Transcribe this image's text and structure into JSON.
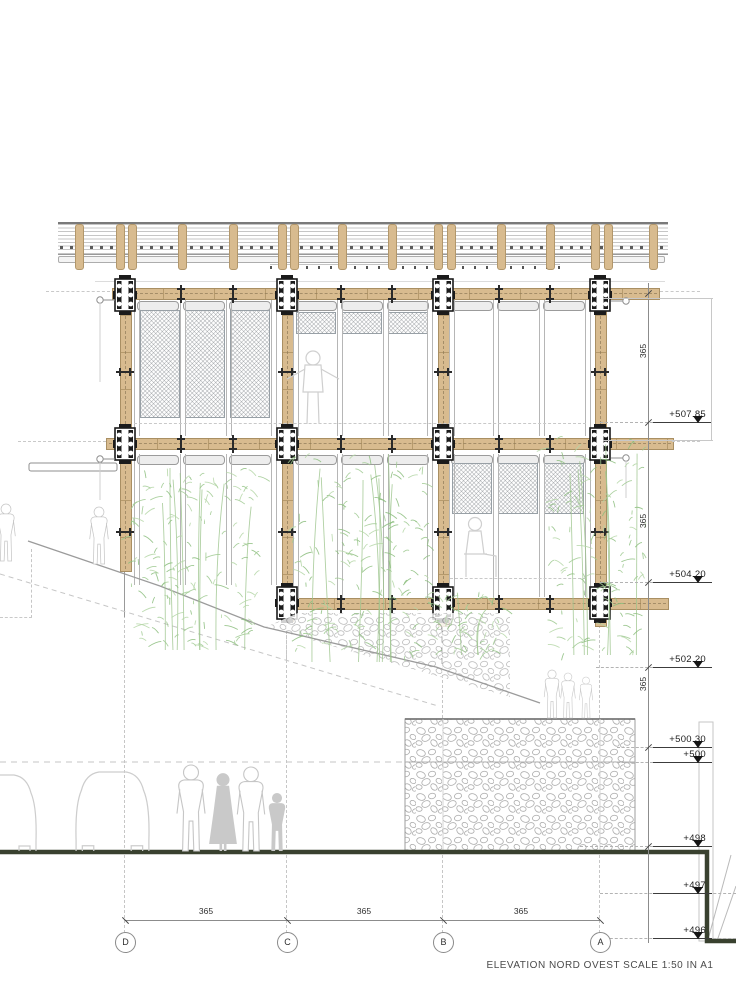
{
  "title": {
    "text": "ELEVATION NORD OVEST SCALE 1:50 IN A1"
  },
  "grid_bubbles": [
    {
      "label": "D"
    },
    {
      "label": "C"
    },
    {
      "label": "B"
    },
    {
      "label": "A"
    }
  ],
  "dim_bottom": [
    {
      "label": "365"
    },
    {
      "label": "365"
    },
    {
      "label": "365"
    }
  ],
  "dim_right": [
    {
      "label": "365"
    },
    {
      "label": "365"
    },
    {
      "label": "365"
    }
  ],
  "elevation_markers": [
    {
      "label": "+507.85"
    },
    {
      "label": "+504.20"
    },
    {
      "label": "+502.20"
    },
    {
      "label": "+500.30"
    },
    {
      "label": "+500"
    },
    {
      "label": "+498"
    },
    {
      "label": "+497"
    },
    {
      "label": "+496"
    }
  ],
  "colors": {
    "wood": "#d8bb8f",
    "joint_steel": "#1b1b1b",
    "ground_line": "#39412f",
    "vegetation": "#a3cb93",
    "figures": "#c9c9c9",
    "stone_outline": "#ababab"
  }
}
